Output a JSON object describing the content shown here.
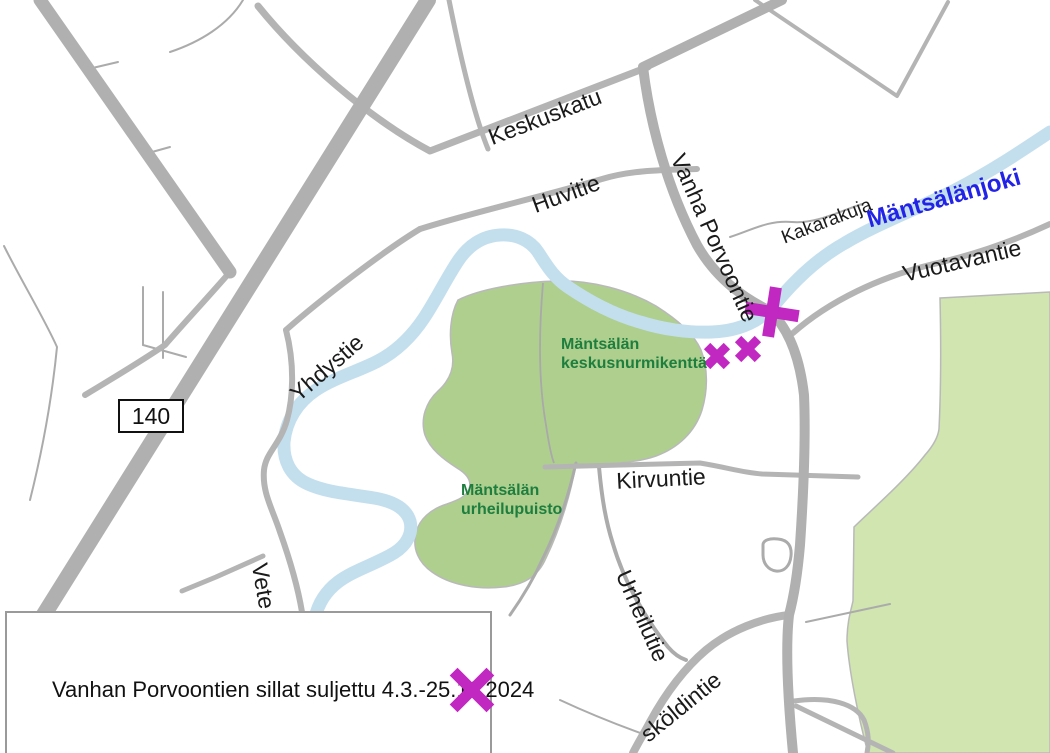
{
  "map": {
    "road_number_badge": "140",
    "road_labels": {
      "keskuskatu": "Keskuskatu",
      "huvitie": "Huvitie",
      "vanha_porvoontie": "Vanha Porvoontie",
      "kakarakuja": "Kakarakuja",
      "vuotavantie": "Vuotavantie",
      "yhdystie": "Yhdystie",
      "kirvuntie": "Kirvuntie",
      "urheilutie": "Urheilutie",
      "skoldintie": "sköldintie",
      "vete": "Vete"
    },
    "river_label": "Mäntsälänjoki",
    "park_labels": {
      "keskusnurmikentta_line1": "Mäntsälän",
      "keskusnurmikentta_line2": "keskusnurmikenttä",
      "urheilupuisto_line1": "Mäntsälän",
      "urheilupuisto_line2": "urheilupuisto"
    }
  },
  "legend": {
    "text": "Vanhan Porvoontien sillat suljettu 4.3.-25.11.2024"
  },
  "colors": {
    "closure_magenta": "#c127c1",
    "river_blue": "#c3dfee",
    "river_label_blue": "#2323e8",
    "park_green_dark": "#afcf8f",
    "park_green_light": "#d0e5af",
    "park_label_green": "#1e7e3e",
    "road_gray": "#b0b0b0"
  }
}
